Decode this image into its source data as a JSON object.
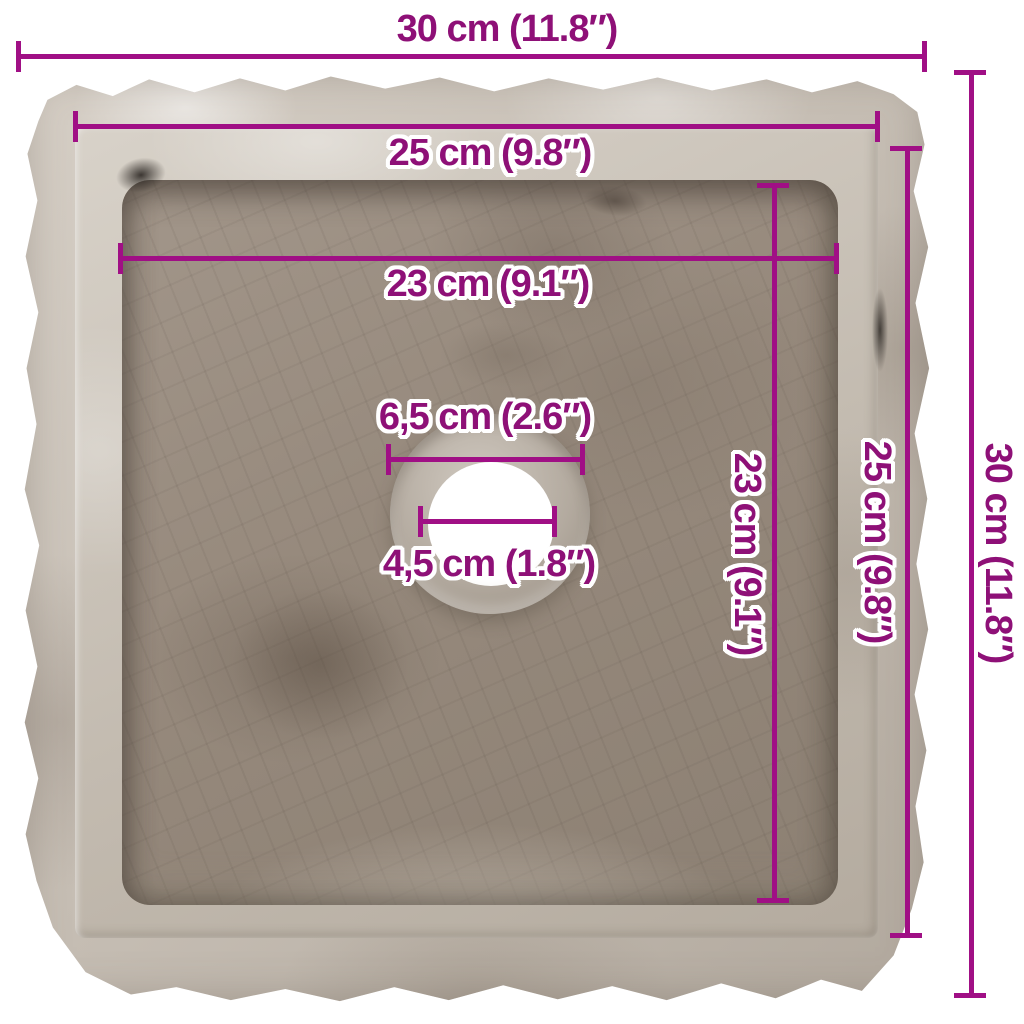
{
  "image": {
    "subject": "square grey marble sink, top view, rough chiselled outer edges, central round drain hole",
    "background_color": "#ffffff"
  },
  "annotation": {
    "line_color": "#a00f85",
    "text_color": "#8e1077",
    "text_outline_color": "#ffffff"
  },
  "dims": {
    "outer_width": {
      "label": "30 cm (11.8″)"
    },
    "rim_width": {
      "label": "25 cm (9.8″)"
    },
    "basin_width": {
      "label": "23 cm (9.1″)"
    },
    "drain_recess": {
      "label": "6,5 cm (2.6″)"
    },
    "drain_hole": {
      "label": "4,5 cm (1.8″)"
    },
    "basin_depth": {
      "label": "23 cm (9.1″)"
    },
    "rim_depth": {
      "label": "25 cm (9.8″)"
    },
    "outer_depth": {
      "label": "30 cm (11.8″)"
    }
  }
}
